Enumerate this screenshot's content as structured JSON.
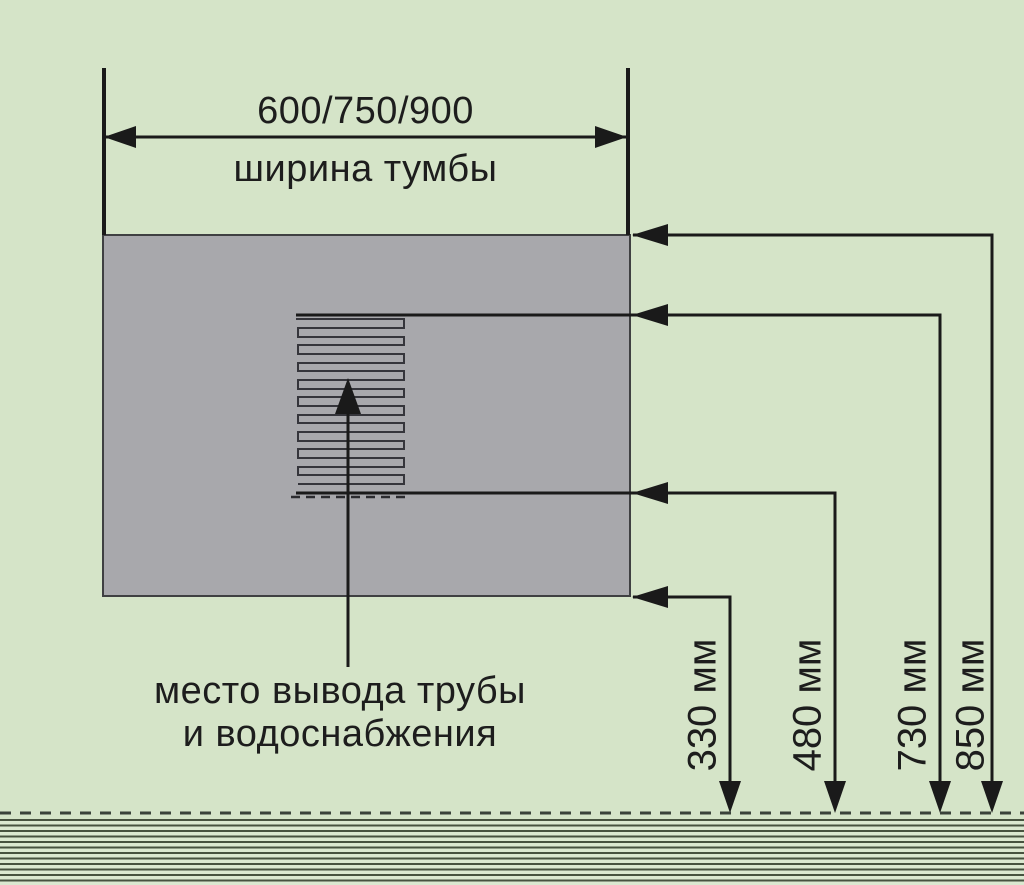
{
  "diagram": {
    "cabinet_width_dimension": {
      "values": "600/750/900",
      "label": "ширина тумбы"
    },
    "outlet_note": {
      "line1": "место вывода трубы",
      "line2": "и водоснабжения"
    },
    "height_dimensions": [
      {
        "label": "330 мм"
      },
      {
        "label": "480 мм"
      },
      {
        "label": "730 мм"
      },
      {
        "label": "850 мм"
      }
    ],
    "colors": {
      "background": "#d5e4c8",
      "cabinet_fill": "#a8a8ac",
      "line": "#1a1a1a",
      "hatch_line": "#35353b",
      "floor_stripe": "#47523f"
    }
  }
}
